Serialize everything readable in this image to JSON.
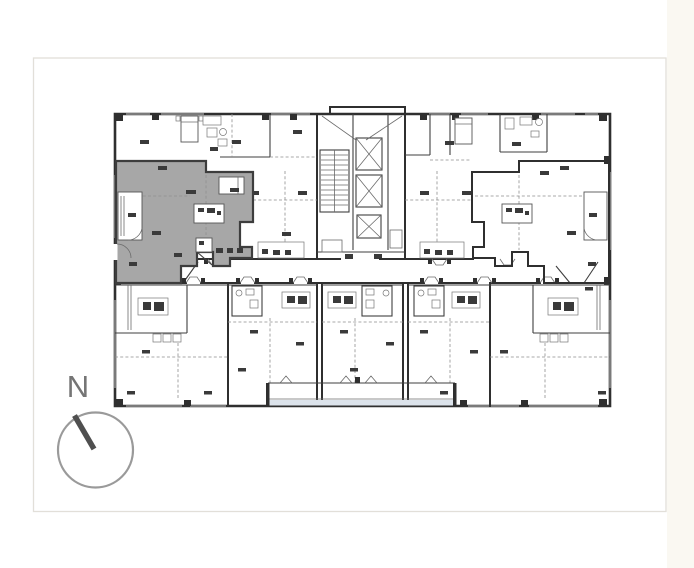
{
  "page": {
    "background_color": "#ffffff",
    "card": {
      "background_color": "#ffffff",
      "border_color": "#e2dfd9"
    },
    "right_margin_tint": "#faf8f2"
  },
  "compass": {
    "label": "N",
    "label_color": "#757575",
    "circle_color": "#9a9a9a",
    "needle_color": "#4f4f4f"
  },
  "floor_plan": {
    "type": "apartment-building-floor-plan",
    "wall_color": "#2f2f2f",
    "partition_color": "#6b6b6b",
    "dashed_line_color": "#8f8f8f",
    "window_color": "#c4c4c4",
    "balcony_glass_color": "#dce3eb",
    "highlighted_unit": {
      "location": "upper-left",
      "fill_color": "#a7a7a7",
      "border_color": "#3d3d3d"
    },
    "core": {
      "elevator_count": 3,
      "has_staircase": true
    }
  }
}
